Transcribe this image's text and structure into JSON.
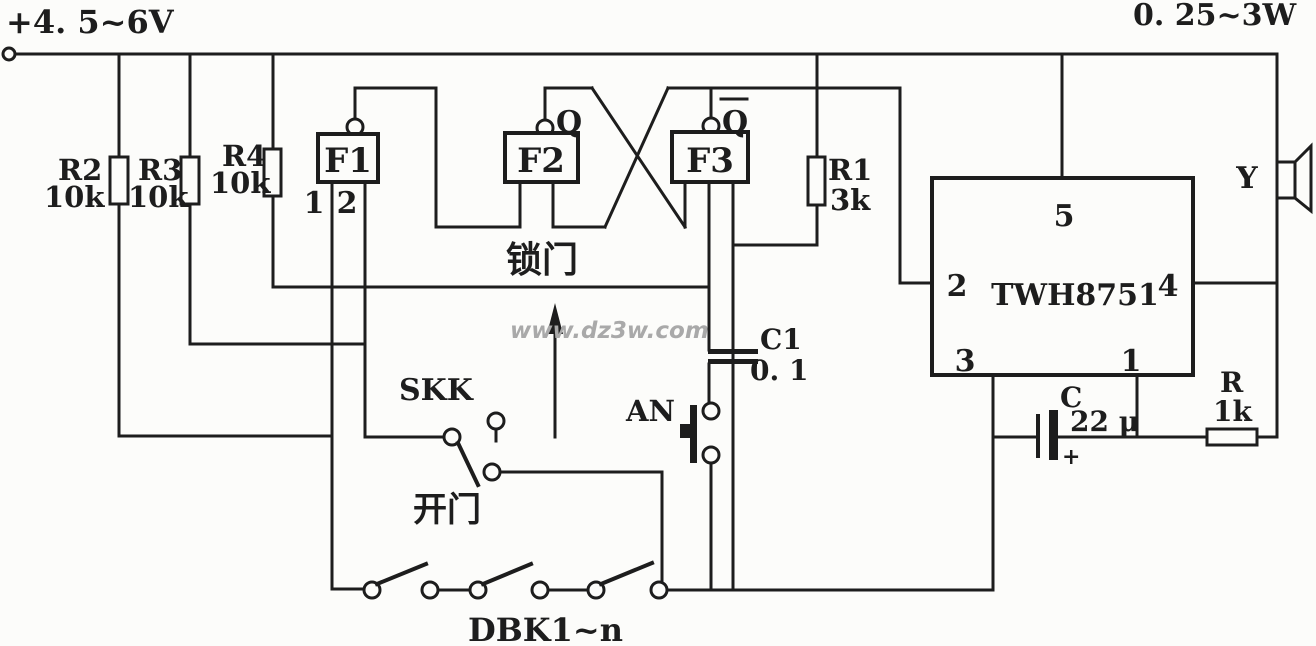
{
  "labels": {
    "supply_voltage": "+4. 5~6V",
    "output_power": "0. 25~3W",
    "lock_door": "锁门",
    "open_door": "开门"
  },
  "components": {
    "r2": {
      "name": "R2",
      "value": "10k"
    },
    "r3": {
      "name": "R3",
      "value": "10k"
    },
    "r4": {
      "name": "R4",
      "value": "10k"
    },
    "r1": {
      "name": "R1",
      "value": "3k"
    },
    "c1": {
      "name": "C1",
      "value": "0. 1"
    },
    "cap": {
      "name": "C",
      "value": "22 μ",
      "polarity": "+"
    },
    "rout": {
      "name": "R",
      "value": "1k"
    },
    "speaker": {
      "label": "Y"
    }
  },
  "blocks": {
    "f1": {
      "label": "F1",
      "pin1": "1",
      "pin2": "2"
    },
    "f2": {
      "label": "F2",
      "output": "Q"
    },
    "f3": {
      "label": "F3",
      "output": "Q",
      "output_inverted": true
    }
  },
  "ic": {
    "name": "TWH8751",
    "pins": {
      "top": "5",
      "left": "2",
      "right": "4",
      "bottom_left": "3",
      "bottom_right": "1"
    }
  },
  "switches": {
    "skk": {
      "label": "SKK"
    },
    "an": {
      "label": "AN"
    },
    "dbk": {
      "label": "DBK1~n"
    }
  },
  "watermark": {
    "text": "www.dz3w.com"
  },
  "colors": {
    "ink": "#1d1d1d",
    "background": "#fcfcfa",
    "watermark": "#a9a9a9"
  }
}
